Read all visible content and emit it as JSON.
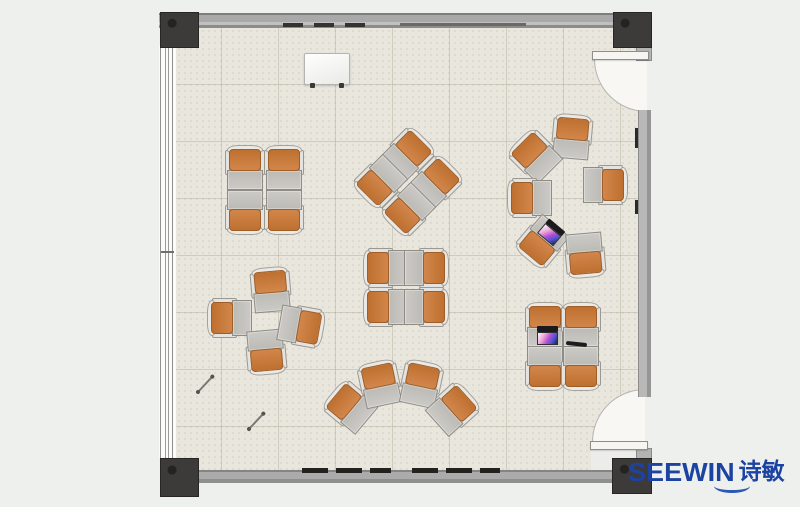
{
  "meta": {
    "description": "Top-down classroom floor plan rendering with clusters of single-student desks and orange chairs",
    "room_label": "classroom"
  },
  "logo": {
    "brand": "SEEWIN",
    "cjk": "诗敏",
    "color": "#1c43a2"
  },
  "palette": {
    "background": "#eef0ee",
    "floor": "#e9e6dd",
    "grid_line": "#b5ad93",
    "wall": "#a9a9a9",
    "column": "#3c3b39",
    "chair_orange": "#c87a38",
    "desk_gray": "#c4c2be",
    "chair_back": "#eae9e5",
    "door_swing": "#f8f7f3",
    "logo_blue": "#1c43a2"
  },
  "furniture": {
    "unit_size": {
      "w": 36,
      "h": 44
    },
    "clusters": [
      {
        "name": "quad-face-to-face-top-left",
        "units": [
          {
            "x": 245,
            "y": 168,
            "r": 180
          },
          {
            "x": 284,
            "y": 168,
            "r": 180
          },
          {
            "x": 245,
            "y": 212,
            "r": 0
          },
          {
            "x": 284,
            "y": 212,
            "r": 0
          }
        ]
      },
      {
        "name": "quad-diamond-top-center",
        "units": [
          {
            "x": 408,
            "y": 154,
            "r": 225
          },
          {
            "x": 436,
            "y": 182,
            "r": 225
          },
          {
            "x": 380,
            "y": 182,
            "r": 45
          },
          {
            "x": 408,
            "y": 210,
            "r": 45
          }
        ]
      },
      {
        "name": "circle-discussion-top-right",
        "units": [
          {
            "x": 572,
            "y": 137,
            "r": 185
          },
          {
            "x": 535,
            "y": 156,
            "r": 135
          },
          {
            "x": 530,
            "y": 198,
            "r": 90
          },
          {
            "x": 542,
            "y": 242,
            "r": 40
          },
          {
            "x": 605,
            "y": 185,
            "r": 270
          },
          {
            "x": 585,
            "y": 255,
            "r": 355
          }
        ]
      },
      {
        "name": "quad-face-to-face-center",
        "units": [
          {
            "x": 386,
            "y": 268,
            "r": 90
          },
          {
            "x": 386,
            "y": 307,
            "r": 90
          },
          {
            "x": 426,
            "y": 268,
            "r": 270
          },
          {
            "x": 426,
            "y": 307,
            "r": 270
          }
        ]
      },
      {
        "name": "pinwheel-left",
        "units": [
          {
            "x": 271,
            "y": 290,
            "r": 175
          },
          {
            "x": 230,
            "y": 318,
            "r": 90
          },
          {
            "x": 266,
            "y": 352,
            "r": 355
          },
          {
            "x": 301,
            "y": 326,
            "r": 280
          }
        ]
      },
      {
        "name": "arc-fan-bottom-center",
        "units": [
          {
            "x": 350,
            "y": 407,
            "r": 130
          },
          {
            "x": 380,
            "y": 384,
            "r": 168
          },
          {
            "x": 421,
            "y": 384,
            "r": 192
          },
          {
            "x": 453,
            "y": 409,
            "r": 228
          }
        ]
      },
      {
        "name": "quad-face-to-face-bottom-right",
        "units": [
          {
            "x": 545,
            "y": 325,
            "r": 180
          },
          {
            "x": 581,
            "y": 325,
            "r": 180
          },
          {
            "x": 545,
            "y": 368,
            "r": 0
          },
          {
            "x": 581,
            "y": 368,
            "r": 0
          }
        ]
      }
    ]
  },
  "objects": [
    {
      "type": "whiteboard",
      "x": 304,
      "y": 53,
      "w": 44,
      "h": 30
    },
    {
      "type": "laptop",
      "x": 541,
      "y": 223,
      "r": 40
    },
    {
      "type": "laptop",
      "x": 537,
      "y": 326,
      "r": 0
    },
    {
      "type": "phone",
      "x": 566,
      "y": 342,
      "r": 6
    },
    {
      "type": "pen",
      "x1": 198,
      "y1": 391,
      "x2": 212,
      "y2": 376
    },
    {
      "type": "pen",
      "x1": 249,
      "y1": 428,
      "x2": 263,
      "y2": 413
    }
  ]
}
